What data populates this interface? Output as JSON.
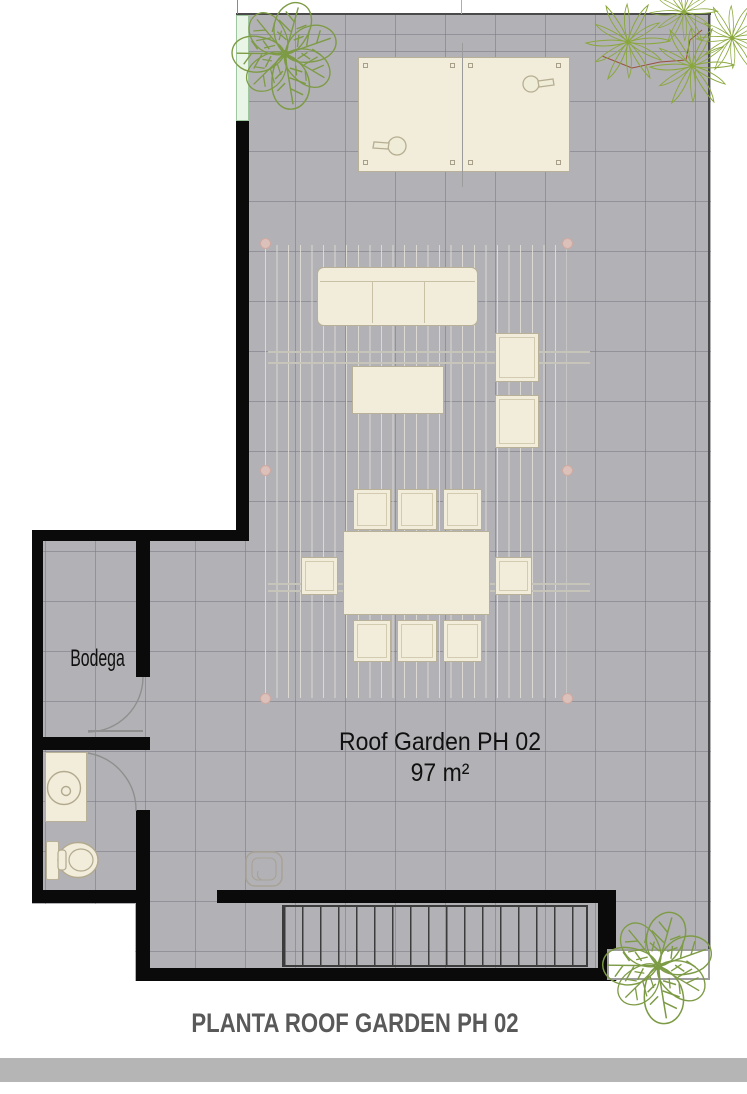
{
  "title": "PLANTA ROOF GARDEN PH 02",
  "labels": {
    "bodega": "Bodega",
    "garden_name": "Roof Garden PH 02",
    "garden_area": "97 m²"
  },
  "colors": {
    "floor": "#b2b1b5",
    "grid_line": "#7a7983",
    "wall": "#0a0a0a",
    "furniture_fill": "#f1edda",
    "furniture_outline": "#b9b098",
    "pergola_slat": "#e2e0d6",
    "post_marker_pink": "#dcc0ba",
    "plant_green": "#7d9b45",
    "palm_green": "#8aa83c",
    "branch_red": "#9b5040",
    "window_glass": "#e9f5e6",
    "title_text": "#595959",
    "footer_bar": "#b5b5b5",
    "stair_line": "#3c3c3c"
  },
  "furniture_shown": [
    "ping-pong-table",
    "sofa",
    "coffee-table",
    "armchair",
    "armchair",
    "dining-table",
    "dining-chair-x8",
    "storage-room",
    "wc-toilet",
    "wc-vanity-sink",
    "stairs",
    "pergola",
    "planter",
    "plants-x3",
    "floor-drain"
  ]
}
